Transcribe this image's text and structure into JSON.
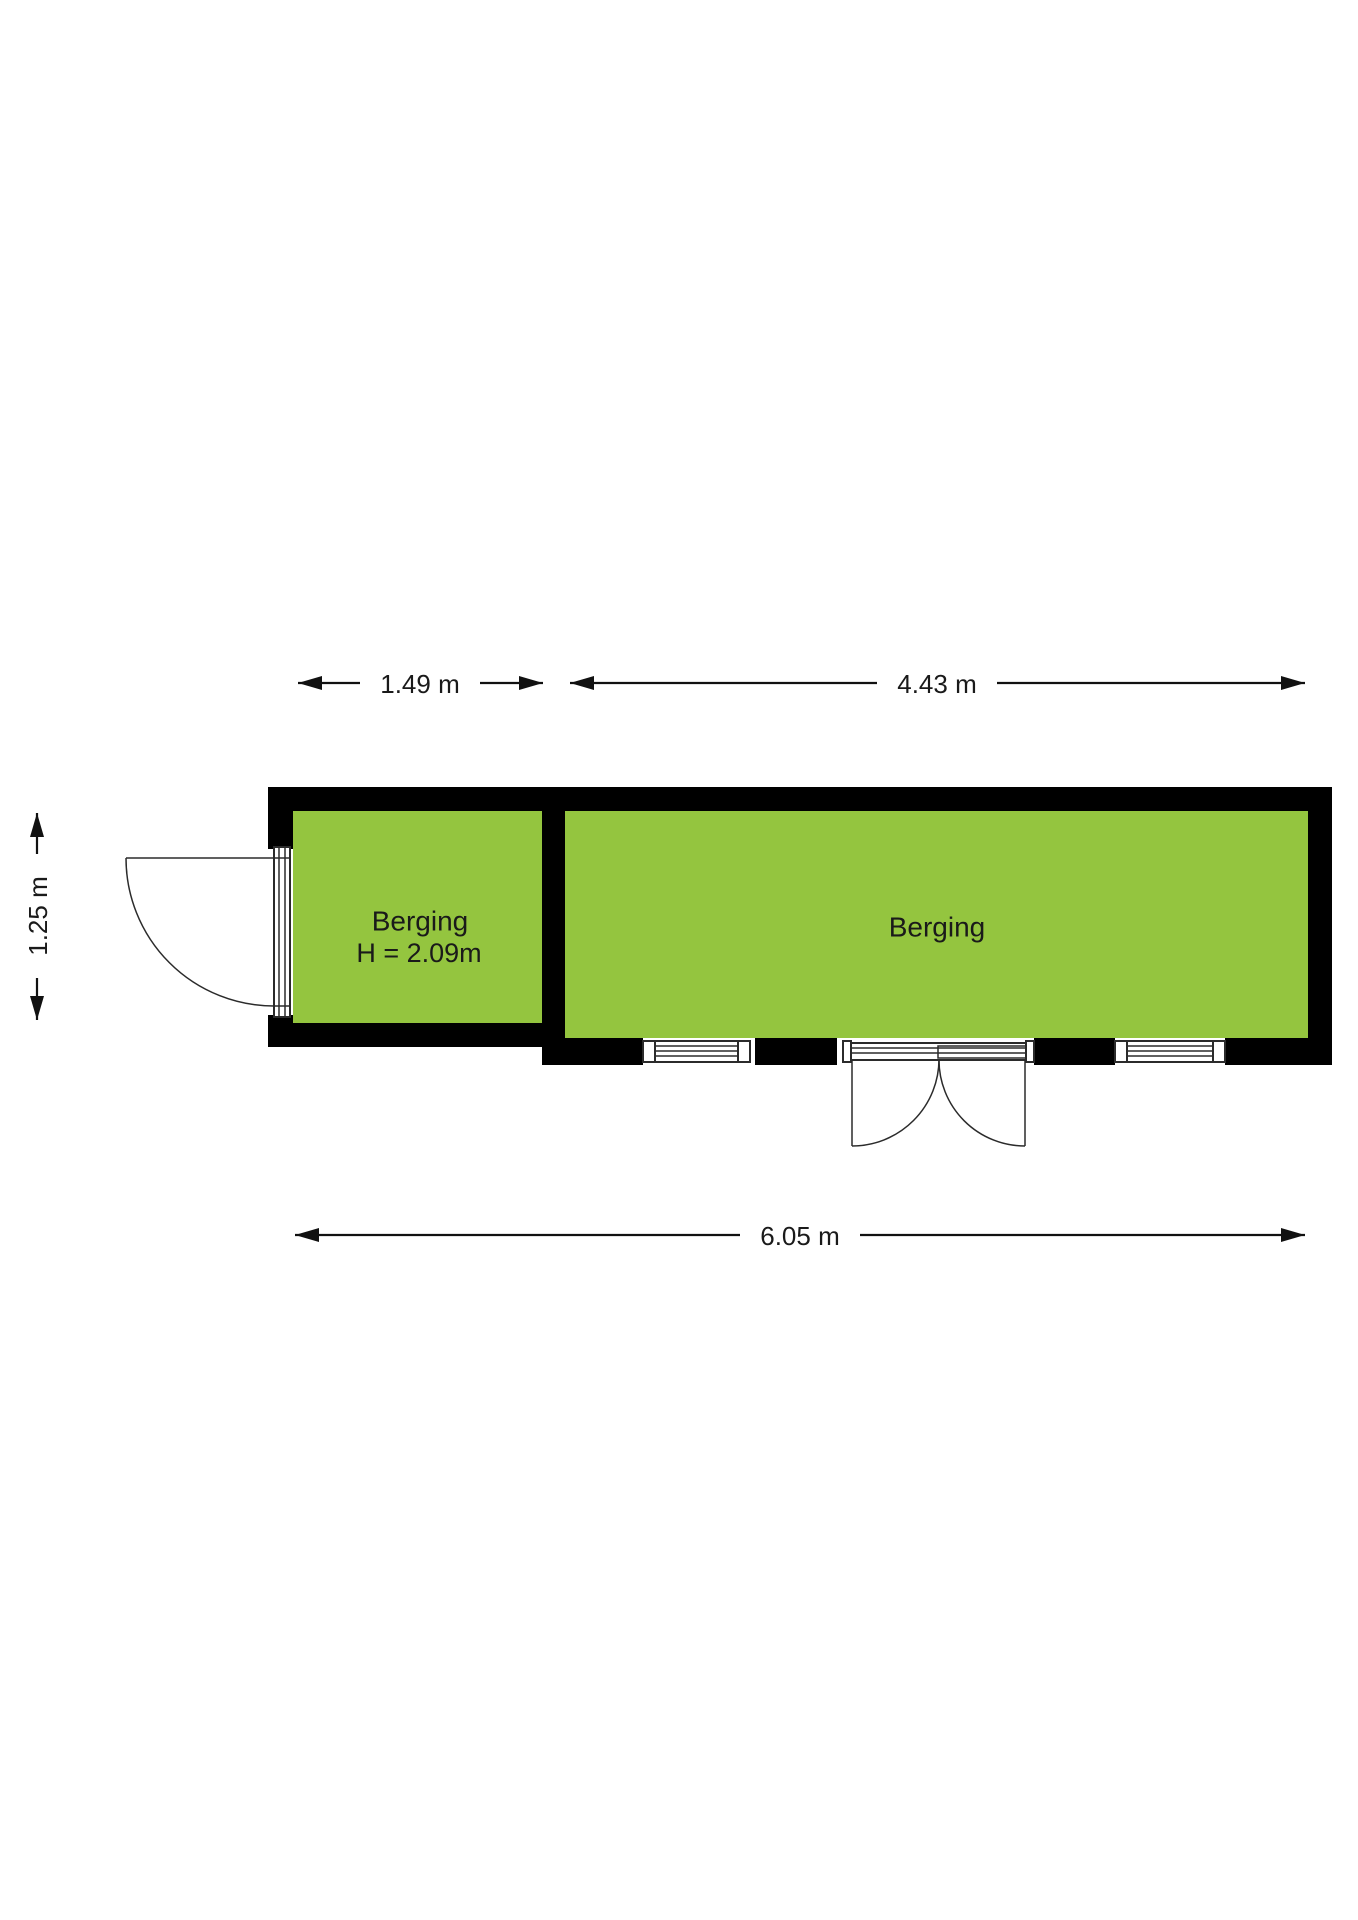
{
  "plan": {
    "rooms": [
      {
        "name": "Berging",
        "height_label": "H = 2.09m"
      },
      {
        "name": "Berging"
      }
    ],
    "dimensions": {
      "top_left": "1.49 m",
      "top_right": "4.43 m",
      "left": "1.25 m",
      "bottom": "6.05 m"
    },
    "colors": {
      "room_fill": "#94C53F",
      "wall": "#000000",
      "text": "#1A1A1A",
      "background": "#FFFFFF"
    }
  }
}
